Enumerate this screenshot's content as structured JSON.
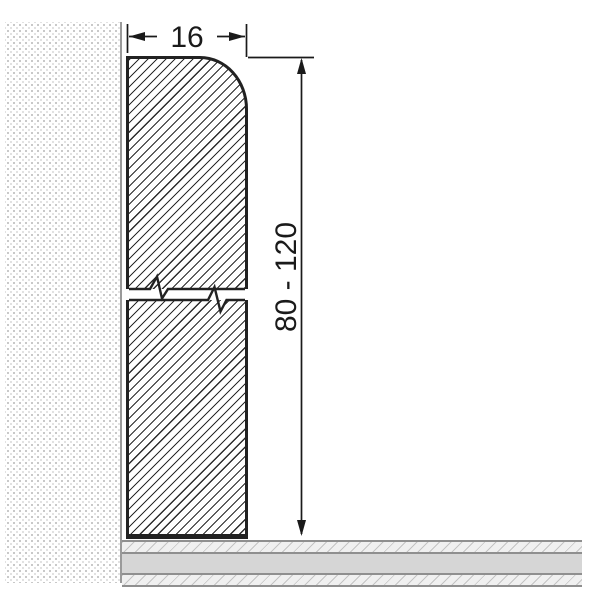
{
  "dimensions": {
    "width": {
      "label": "16",
      "value": 16
    },
    "height": {
      "label": "80 - 120",
      "min": 80,
      "max": 120
    }
  },
  "colors": {
    "background": "#ffffff",
    "line": "#1a1a1a",
    "edge": "#222222",
    "hatch": "#2b2b2b",
    "wall_dot": "#c8c8c8",
    "wall_dot_light": "#e2e2e2",
    "wall_edge": "#9a9a9a",
    "floor_band": "#d6d6d6",
    "floor_line": "#8f8f8f",
    "floor_hatch_bg": "#f0f0f0",
    "floor_hatch_line": "#c4c4c4"
  }
}
